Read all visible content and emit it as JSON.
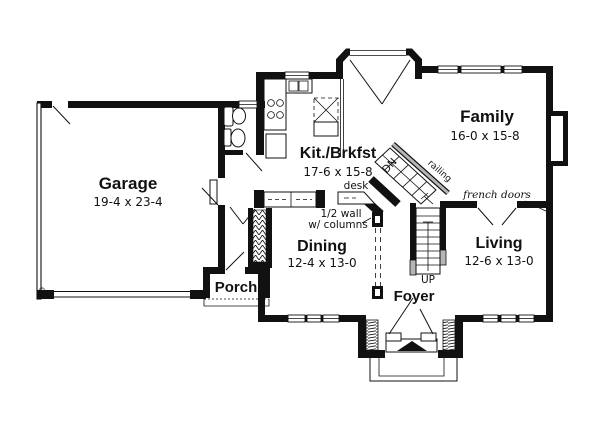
{
  "floorplan": {
    "rooms": {
      "garage": {
        "name": "Garage",
        "dims": "19-4 x 23-4"
      },
      "kitchen": {
        "name": "Kit./Brkfst",
        "dims": "17-6 x 15-8"
      },
      "family": {
        "name": "Family",
        "dims": "16-0 x 15-8"
      },
      "dining": {
        "name": "Dining",
        "dims": "12-4 x 13-0"
      },
      "living": {
        "name": "Living",
        "dims": "12-6 x 13-0"
      },
      "foyer": {
        "name": "Foyer"
      },
      "porch": {
        "name": "Porch"
      }
    },
    "annotations": {
      "desk": "desk",
      "half_wall": "1/2 wall",
      "half_wall2": "w/ columns",
      "french_doors": "french doors",
      "up": "UP",
      "dn": "DN",
      "railing": "railing",
      "copyright": "©"
    },
    "symbols": {
      "range": "four-burner-circles",
      "sink": "double-basin-rects",
      "refrigerator": "rect",
      "toilet": "tank-and-oval",
      "vanity-sink": "oval-in-rect",
      "fireplace": "bump-out-rect",
      "window": "white-gap-with-sill-line",
      "door-swing": "thin-diagonal-line",
      "stairs": "treaded-run-with-arrow",
      "column": "black-square-white-core",
      "closet": "zigzag-hatch",
      "sidelight": "dense-hatch-strip"
    },
    "colors": {
      "ink": "#111111",
      "paper": "#ffffff",
      "railing_gray": "#b5b5b5"
    }
  }
}
